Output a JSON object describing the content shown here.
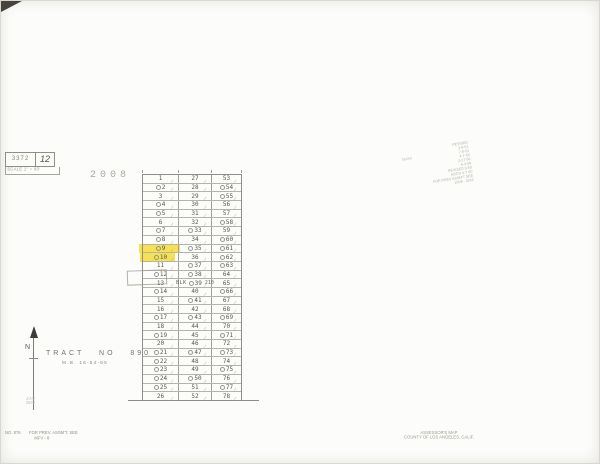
{
  "colors": {
    "highlight_yellow": "#f4d824",
    "paper": "#fcfcfa",
    "grid_line": "#8f8f88",
    "ink": "#56564f",
    "faint_stamp": "#b2b2a8"
  },
  "ref_box": {
    "book": "3372",
    "page": "12",
    "scale": "SCALE 1\" = 80'"
  },
  "sheet_label": "2008",
  "grid": {
    "blk_label": "BLK",
    "blk_page": "210",
    "highlight_rows": [
      9,
      10
    ],
    "rows": [
      {
        "c1": "1",
        "c2": "27",
        "c3": "53",
        "o": [
          0,
          0,
          0
        ]
      },
      {
        "c1": "2",
        "c2": "28",
        "c3": "54",
        "o": [
          1,
          0,
          1
        ]
      },
      {
        "c1": "3",
        "c2": "29",
        "c3": "55",
        "o": [
          0,
          0,
          1
        ]
      },
      {
        "c1": "4",
        "c2": "30",
        "c3": "56",
        "o": [
          1,
          0,
          0
        ]
      },
      {
        "c1": "5",
        "c2": "31",
        "c3": "57",
        "o": [
          1,
          0,
          0
        ]
      },
      {
        "c1": "6",
        "c2": "32",
        "c3": "58",
        "o": [
          0,
          0,
          1
        ]
      },
      {
        "c1": "7",
        "c2": "33",
        "c3": "59",
        "o": [
          1,
          1,
          0
        ]
      },
      {
        "c1": "8",
        "c2": "34",
        "c3": "60",
        "o": [
          1,
          0,
          1
        ]
      },
      {
        "c1": "9",
        "c2": "35",
        "c3": "61",
        "o": [
          1,
          1,
          1
        ]
      },
      {
        "c1": "10",
        "c2": "36",
        "c3": "62",
        "o": [
          1,
          0,
          1
        ]
      },
      {
        "c1": "11",
        "c2": "37",
        "c3": "63",
        "o": [
          0,
          1,
          1
        ]
      },
      {
        "c1": "12",
        "c2": "38",
        "c3": "64",
        "o": [
          1,
          1,
          0
        ]
      },
      {
        "c1": "13",
        "c2": "39",
        "c3": "65",
        "o": [
          0,
          1,
          0
        ]
      },
      {
        "c1": "14",
        "c2": "40",
        "c3": "66",
        "o": [
          1,
          0,
          1
        ]
      },
      {
        "c1": "15",
        "c2": "41",
        "c3": "67",
        "o": [
          0,
          1,
          0
        ]
      },
      {
        "c1": "16",
        "c2": "42",
        "c3": "68",
        "o": [
          0,
          0,
          0
        ]
      },
      {
        "c1": "17",
        "c2": "43",
        "c3": "69",
        "o": [
          1,
          1,
          1
        ]
      },
      {
        "c1": "18",
        "c2": "44",
        "c3": "70",
        "o": [
          0,
          0,
          0
        ]
      },
      {
        "c1": "19",
        "c2": "45",
        "c3": "71",
        "o": [
          1,
          0,
          1
        ]
      },
      {
        "c1": "20",
        "c2": "46",
        "c3": "72",
        "o": [
          0,
          0,
          0
        ]
      },
      {
        "c1": "21",
        "c2": "47",
        "c3": "73",
        "o": [
          1,
          1,
          1
        ]
      },
      {
        "c1": "22",
        "c2": "48",
        "c3": "74",
        "o": [
          1,
          0,
          0
        ]
      },
      {
        "c1": "23",
        "c2": "49",
        "c3": "75",
        "o": [
          1,
          0,
          1
        ]
      },
      {
        "c1": "24",
        "c2": "50",
        "c3": "76",
        "o": [
          1,
          1,
          0
        ]
      },
      {
        "c1": "25",
        "c2": "51",
        "c3": "77",
        "o": [
          1,
          0,
          1
        ]
      },
      {
        "c1": "26",
        "c2": "52",
        "c3": "78",
        "o": [
          0,
          0,
          0
        ]
      }
    ]
  },
  "tract": {
    "title": "TRACT   NO   890",
    "map_book": "M.B. 16-54-55"
  },
  "north_label": "N",
  "corner_note": {
    "line1": "2008",
    "line2": "2542"
  },
  "revision_stamp": {
    "side_label": "36550",
    "lines": [
      "REVISED",
      "2-8-51",
      "7-8-54",
      "4-7-55",
      "2-27-56",
      "6-3-58",
      "REVISED 3-59",
      "ASS'D 4-7-60",
      "FOR PREV ASSM'T SEE",
      "2008 - 2542"
    ]
  },
  "footer_left": {
    "number": "NO. 876",
    "note": "FOR PREV. ASSM'T. SEE",
    "note2": "MFV - 8"
  },
  "footer_right": {
    "line1": "ASSESSOR'S MAP",
    "line2": "COUNTY OF LOS ANGELES, CALIF."
  }
}
